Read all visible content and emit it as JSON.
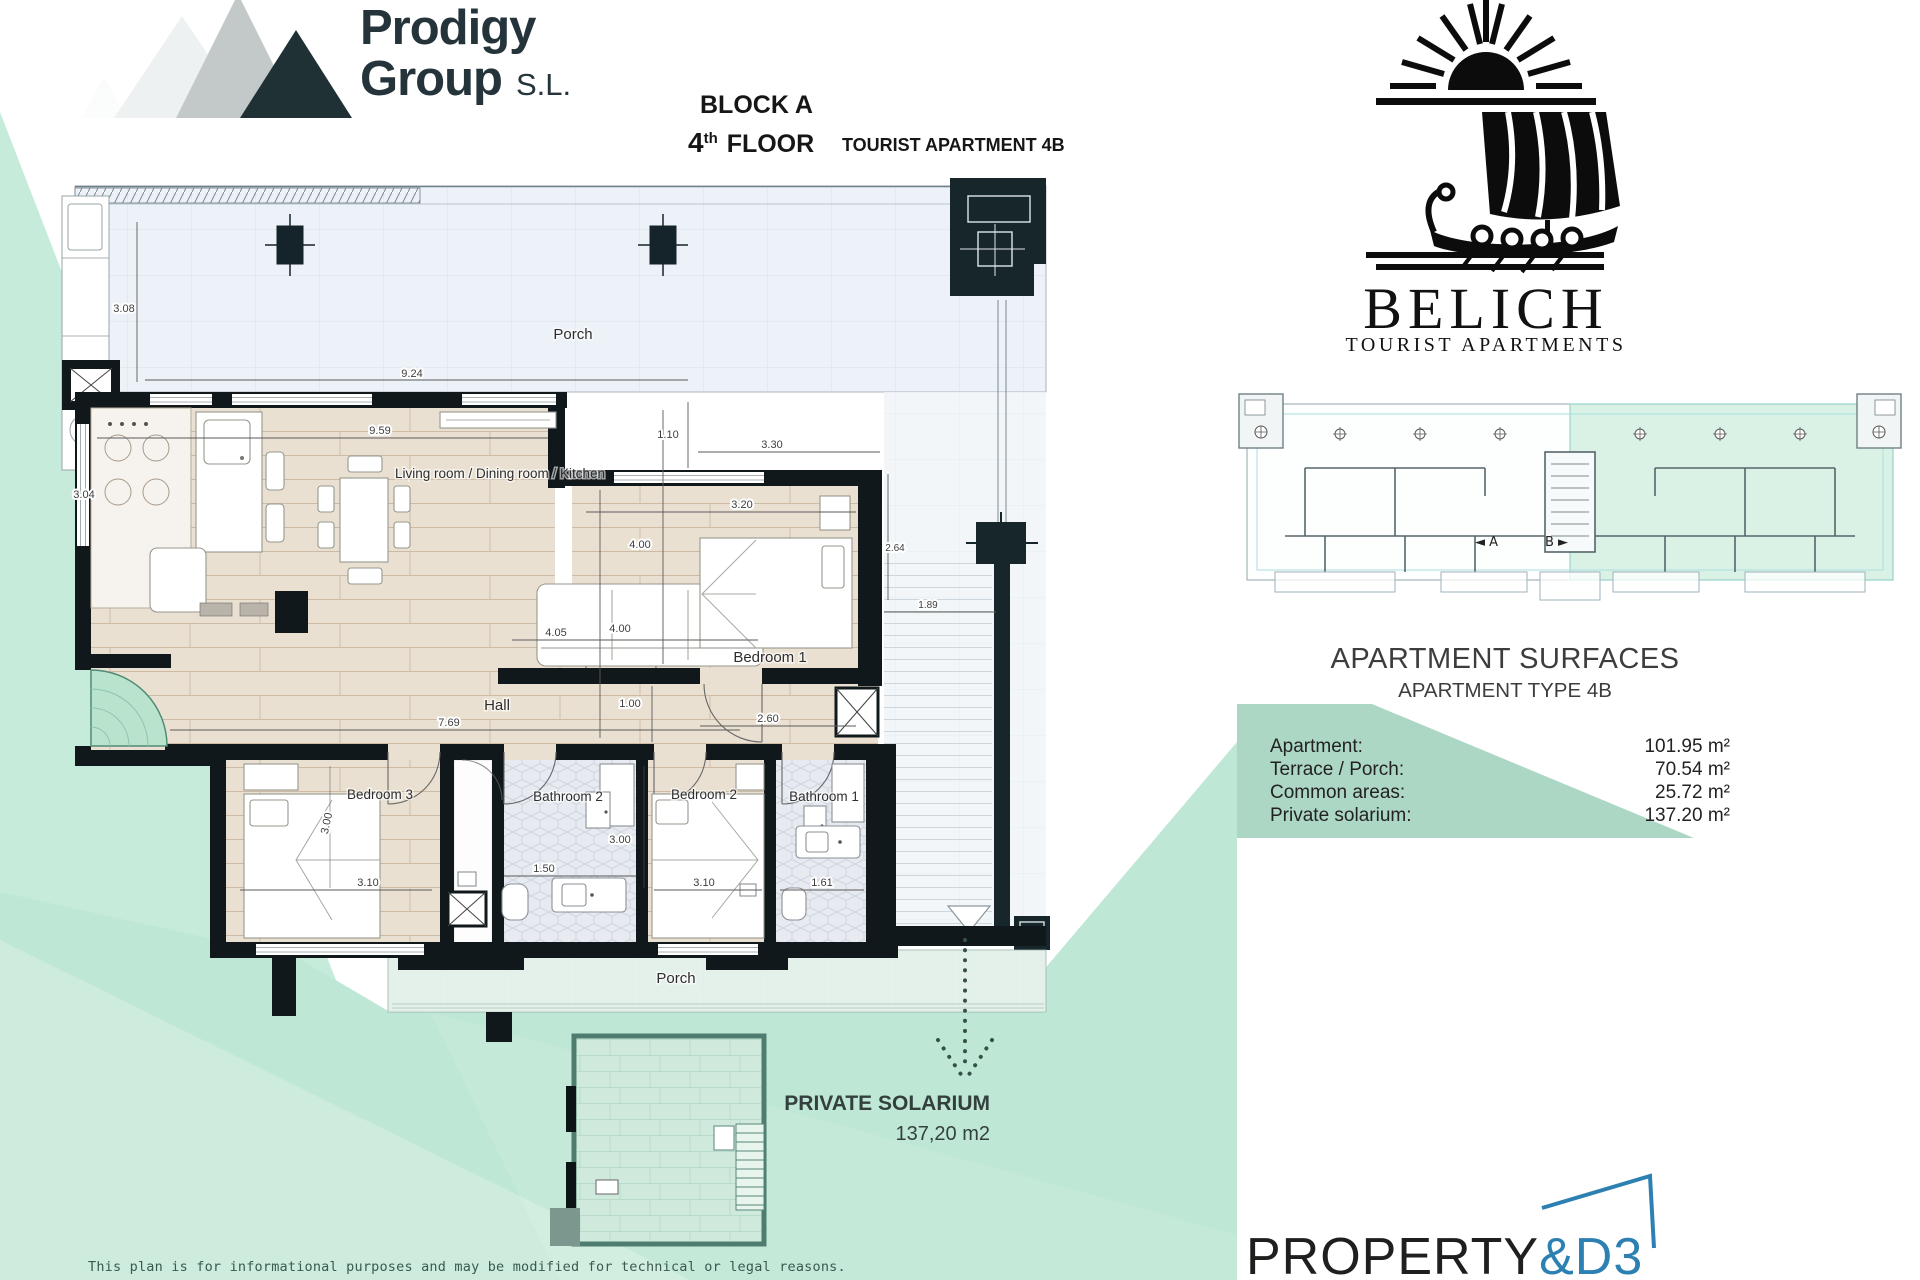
{
  "branding": {
    "prodigy": {
      "line1": "Prodigy",
      "line2": "Group",
      "suffix": "S.L."
    },
    "belich": {
      "name": "BELICH",
      "subtitle": "TOURIST APARTMENTS"
    },
    "property_d3": {
      "black": "PROPERTY",
      "blue": "&D3"
    }
  },
  "header": {
    "block": "BLOCK A",
    "floor_num": "4",
    "floor_sup": "th",
    "floor_word": " FLOOR",
    "apartment": "TOURIST APARTMENT 4B"
  },
  "plan": {
    "rooms": {
      "porch_top": "Porch",
      "living": "Living room / Dining room / Kitchen",
      "bedroom1": "Bedroom 1",
      "hall": "Hall",
      "bedroom3": "Bedroom 3",
      "bathroom2": "Bathroom 2",
      "bedroom2": "Bedroom 2",
      "bathroom1": "Bathroom 1",
      "porch_bottom": "Porch"
    },
    "dims": {
      "porch_height": "3.08",
      "porch_width": "9.24",
      "living_width": "9.59",
      "kitchen_height": "3.04",
      "living_height": "4.00",
      "recess_depth": "1.10",
      "bedroom1_porch_width": "3.30",
      "bedroom1_width": "3.20",
      "bedroom1_side": "2.64",
      "bedroom1_height": "4.00",
      "sofa_width": "4.05",
      "terrace_width": "1.89",
      "hall_width": "7.69",
      "hall_opening": "1.00",
      "bedroom1_door": "2.60",
      "bedroom3_height": "3.00",
      "bedroom3_width": "3.10",
      "bathroom2_width": "1.50",
      "bedroom2_height": "3.00",
      "bedroom2_width": "3.10",
      "bathroom1_width": "1.61"
    }
  },
  "solarium": {
    "title": "PRIVATE SOLARIUM",
    "area": "137,20 m2"
  },
  "key_plan": {
    "unit_a": "◄ A",
    "unit_b": "B ►"
  },
  "surfaces": {
    "title": "APARTMENT SURFACES",
    "subtitle": "APARTMENT TYPE 4B",
    "rows": [
      {
        "label": "Apartment:",
        "value": "101.95 m²"
      },
      {
        "label": "Terrace / Porch:",
        "value": "70.54 m²"
      },
      {
        "label": "Common areas:",
        "value": "25.72 m²"
      },
      {
        "label": "Private solarium:",
        "value": "137.20 m²"
      }
    ]
  },
  "footer": {
    "disclaimer": "This plan is for informational purposes and may be modified for technical or legal reasons."
  },
  "colors": {
    "mint": "#c7ebdb",
    "mint_dark": "#bfe7d5",
    "table_green": "#a7d4c1",
    "wall_black": "#11181b",
    "dark_block": "#17262b",
    "wood": "#eae0d2",
    "porch_blue": "#ecf2f7",
    "accent_blue": "#2d80b2",
    "logo_dark": "#24343a"
  }
}
